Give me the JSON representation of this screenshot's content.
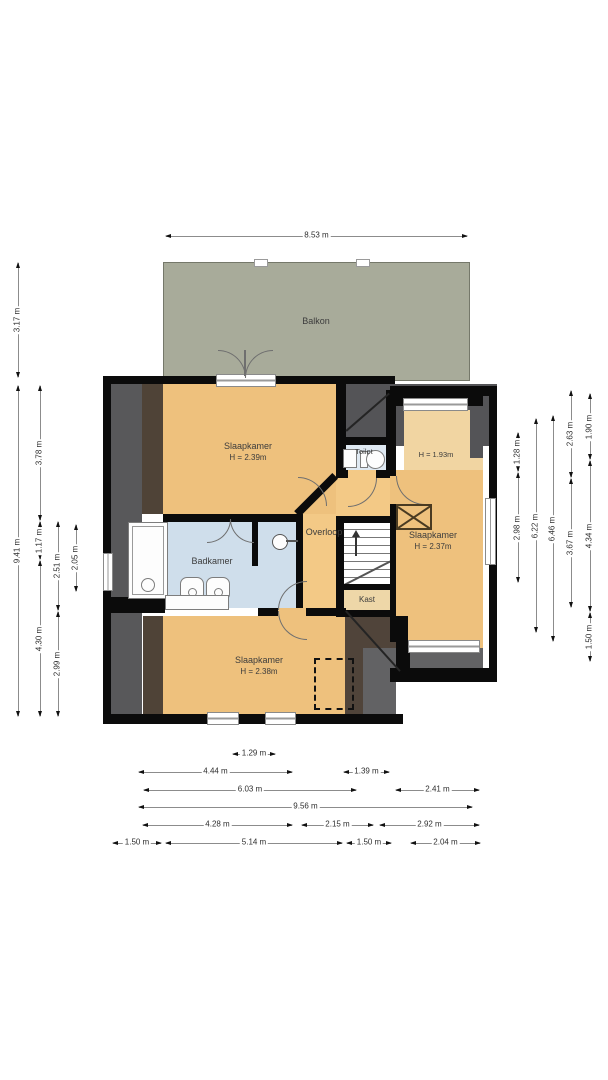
{
  "rooms": {
    "balkon": {
      "label": "Balkon"
    },
    "slaapkamer_top": {
      "label": "Slaapkamer",
      "height": "H = 2.39m"
    },
    "toilet": {
      "label": "Toilet"
    },
    "laag_gedeelte": {
      "height": "H = 1.93m"
    },
    "badkamer": {
      "label": "Badkamer"
    },
    "overloop": {
      "label": "Overloop"
    },
    "slaapkamer_rechts": {
      "label": "Slaapkamer",
      "height": "H = 2.37m"
    },
    "kast": {
      "label": "Kast"
    },
    "slaapkamer_onder": {
      "label": "Slaapkamer",
      "height": "H = 2.38m"
    }
  },
  "colors": {
    "wall": "#0b0b0b",
    "floor_tan": "#eec17d",
    "floor_tan_light": "#f1d5a2",
    "overloop_tan": "#f3c986",
    "bath_blue": "#cfdeeb",
    "toilet_blue": "#dfe9f2",
    "balcony_green": "#a8ab9a",
    "slope_gray": "#58585a",
    "slope_gray_dark": "#545457",
    "slope_brown": "#4f4337",
    "corner_gray": "#626264"
  },
  "dimensions": [
    {
      "o": "h",
      "x": 165,
      "y": 236,
      "len": 303,
      "label": "8.53 m"
    },
    {
      "o": "v",
      "x": 18,
      "y": 262,
      "len": 116,
      "label": "3.17 m"
    },
    {
      "o": "v",
      "x": 18,
      "y": 385,
      "len": 332,
      "label": "9.41 m"
    },
    {
      "o": "v",
      "x": 40,
      "y": 385,
      "len": 136,
      "label": "3.78 m"
    },
    {
      "o": "v",
      "x": 40,
      "y": 521,
      "len": 39,
      "label": "1.17 m"
    },
    {
      "o": "v",
      "x": 40,
      "y": 560,
      "len": 157,
      "label": "4.30 m"
    },
    {
      "o": "v",
      "x": 58,
      "y": 521,
      "len": 90,
      "label": "2.51 m"
    },
    {
      "o": "v",
      "x": 58,
      "y": 611,
      "len": 106,
      "label": "2.99 m"
    },
    {
      "o": "v",
      "x": 76,
      "y": 524,
      "len": 68,
      "label": "2.05 m"
    },
    {
      "o": "v",
      "x": 518,
      "y": 432,
      "len": 40,
      "label": "1.28 m"
    },
    {
      "o": "v",
      "x": 518,
      "y": 472,
      "len": 111,
      "label": "2.98 m"
    },
    {
      "o": "v",
      "x": 536,
      "y": 418,
      "len": 215,
      "label": "6.22 m"
    },
    {
      "o": "v",
      "x": 553,
      "y": 415,
      "len": 227,
      "label": "6.46 m"
    },
    {
      "o": "v",
      "x": 571,
      "y": 390,
      "len": 88,
      "label": "2.63 m"
    },
    {
      "o": "v",
      "x": 571,
      "y": 478,
      "len": 130,
      "label": "3.67 m"
    },
    {
      "o": "v",
      "x": 590,
      "y": 393,
      "len": 67,
      "label": "1.90 m"
    },
    {
      "o": "v",
      "x": 590,
      "y": 460,
      "len": 152,
      "label": "4.34 m"
    },
    {
      "o": "v",
      "x": 590,
      "y": 612,
      "len": 50,
      "label": "1.50 m"
    },
    {
      "o": "h",
      "x": 232,
      "y": 754,
      "len": 44,
      "label": "1.29 m"
    },
    {
      "o": "h",
      "x": 138,
      "y": 772,
      "len": 155,
      "label": "4.44 m"
    },
    {
      "o": "h",
      "x": 343,
      "y": 772,
      "len": 47,
      "label": "1.39 m"
    },
    {
      "o": "h",
      "x": 143,
      "y": 790,
      "len": 214,
      "label": "6.03 m"
    },
    {
      "o": "h",
      "x": 395,
      "y": 790,
      "len": 85,
      "label": "2.41 m"
    },
    {
      "o": "h",
      "x": 138,
      "y": 807,
      "len": 335,
      "label": "9.56 m"
    },
    {
      "o": "h",
      "x": 142,
      "y": 825,
      "len": 151,
      "label": "4.28 m"
    },
    {
      "o": "h",
      "x": 301,
      "y": 825,
      "len": 73,
      "label": "2.15 m"
    },
    {
      "o": "h",
      "x": 379,
      "y": 825,
      "len": 101,
      "label": "2.92 m"
    },
    {
      "o": "h",
      "x": 112,
      "y": 843,
      "len": 50,
      "label": "1.50 m"
    },
    {
      "o": "h",
      "x": 165,
      "y": 843,
      "len": 178,
      "label": "5.14 m"
    },
    {
      "o": "h",
      "x": 346,
      "y": 843,
      "len": 46,
      "label": "1.50 m"
    },
    {
      "o": "h",
      "x": 410,
      "y": 843,
      "len": 71,
      "label": "2.04 m"
    },
    {
      "o": "h",
      "x": 480,
      "y": 843,
      "len": 0,
      "label": ""
    }
  ]
}
